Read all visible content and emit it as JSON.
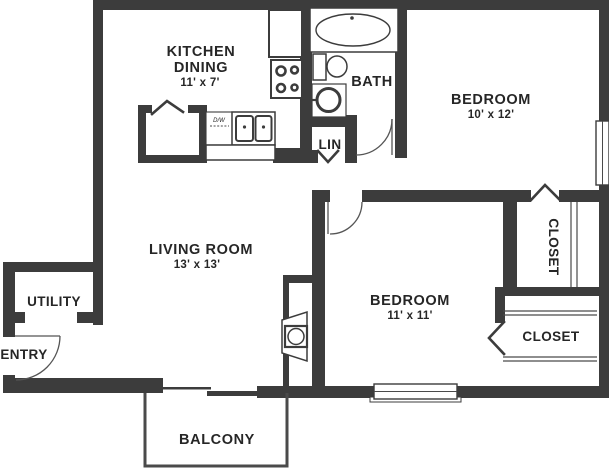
{
  "colors": {
    "wall": "#3c3c3c",
    "line": "#4a4a4a",
    "text": "#262626",
    "bg": "#ffffff"
  },
  "rooms": {
    "kitchen_dining": {
      "line1": "KITCHEN",
      "line2": "DINING",
      "dims": "11' x 7'"
    },
    "bath": {
      "label": "BATH"
    },
    "bedroom_top": {
      "label": "BEDROOM",
      "dims": "10' x 12'"
    },
    "living_room": {
      "label": "LIVING ROOM",
      "dims": "13' x 13'"
    },
    "bedroom_bottom": {
      "label": "BEDROOM",
      "dims": "11' x 11'"
    },
    "utility": {
      "label": "UTILITY"
    },
    "entry": {
      "label": "ENTRY"
    },
    "linen_closet": {
      "label": "LIN"
    },
    "closet_top": {
      "label": "CLOSET"
    },
    "closet_bottom": {
      "label": "CLOSET"
    },
    "balcony": {
      "label": "BALCONY"
    },
    "dishwasher": {
      "label": "D/W"
    }
  }
}
